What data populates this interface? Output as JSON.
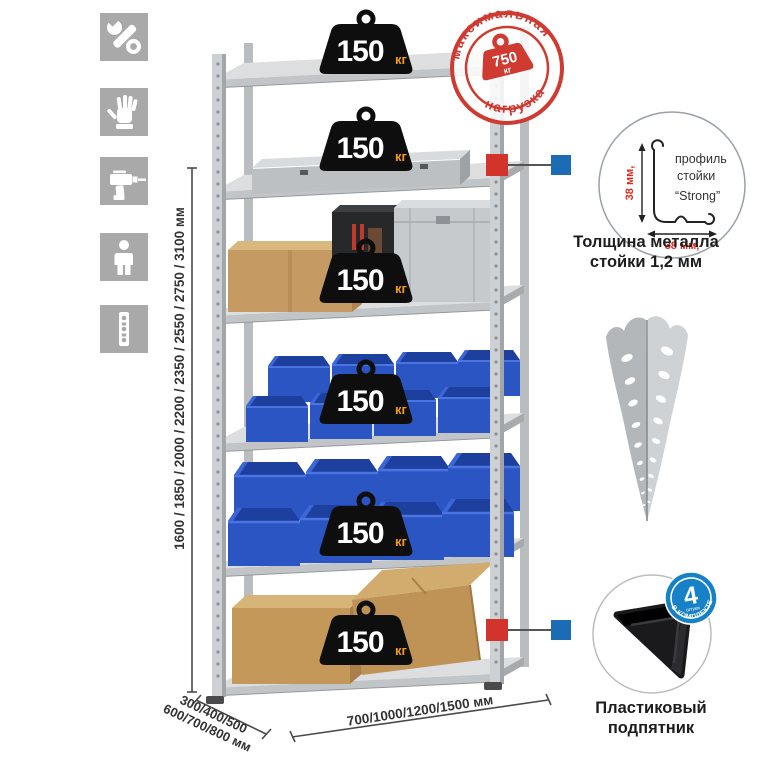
{
  "sidebar": {
    "icons": [
      {
        "name": "wrench"
      },
      {
        "name": "gloves"
      },
      {
        "name": "drill"
      },
      {
        "name": "person"
      },
      {
        "name": "rack-post"
      }
    ]
  },
  "rack": {
    "shelf_count": 6,
    "shelves": [
      {
        "load": "150",
        "unit": "кг"
      },
      {
        "load": "150",
        "unit": "кг"
      },
      {
        "load": "150",
        "unit": "кг"
      },
      {
        "load": "150",
        "unit": "кг"
      },
      {
        "load": "150",
        "unit": "кг"
      },
      {
        "load": "150",
        "unit": "кг"
      }
    ]
  },
  "max_load_stamp": {
    "arc_top": "максимальная",
    "arc_bottom": "нагрузка",
    "value": "750",
    "unit": "кг"
  },
  "dimensions": {
    "height_label": "1600 / 1850 / 2000 / 2200 / 2350 / 2550 / 2750 / 3100 мм",
    "depth_label_line1": "300/400/500",
    "depth_label_line2": "600/700/800 мм",
    "width_label": "700/1000/1200/1500 мм"
  },
  "profile_detail": {
    "line1": "профиль",
    "line2": "стойки",
    "line3": "“Strong”",
    "dim_vertical": "38 мм,",
    "dim_horizontal": "38 мм,",
    "caption_line1": "Толщина металла",
    "caption_line2": "стойки 1,2 мм"
  },
  "foot_detail": {
    "badge_count": "4",
    "badge_count_label": "штуки",
    "badge_band": "в комплекте",
    "caption_line1": "Пластиковый",
    "caption_line2": "подпятник"
  },
  "colors": {
    "stamp_red": "#cf3a31",
    "marker_red": "#d2342b",
    "marker_blue": "#1c6cb5",
    "badge_blue": "#1681c6",
    "bin_blue": "#2c55c4",
    "weight_black": "#0e0e0e",
    "unit_orange": "#f29a1d",
    "icon_gray": "#a9a9a9",
    "metal_gray": "#ced2d5",
    "dim_red": "#e02b20"
  }
}
